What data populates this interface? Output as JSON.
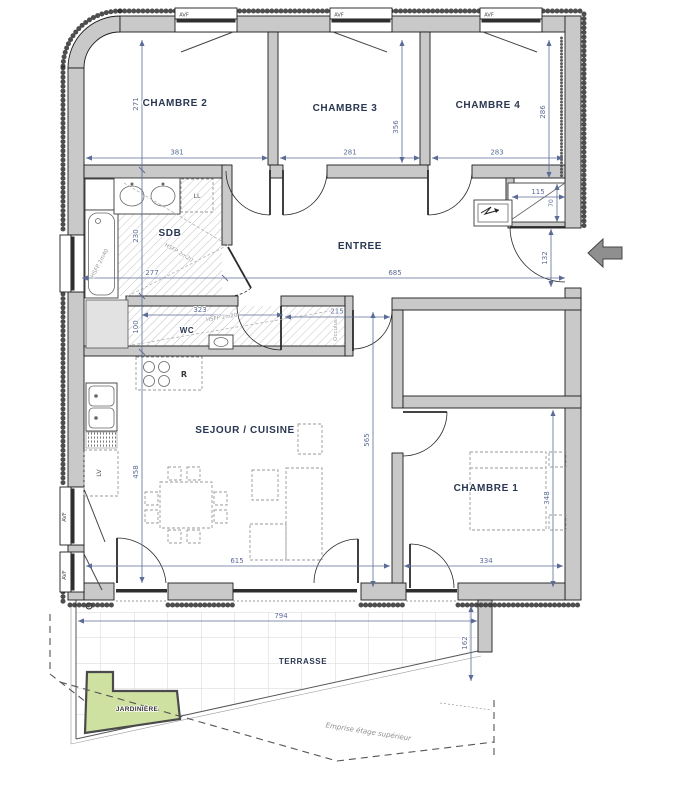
{
  "rooms": {
    "chambre1": "CHAMBRE 1",
    "chambre2": "CHAMBRE 2",
    "chambre3": "CHAMBRE 3",
    "chambre4": "CHAMBRE 4",
    "sdb": "SDB",
    "wc": "WC",
    "entree": "ENTREE",
    "sejour": "SEJOUR / CUISINE",
    "terrasse": "TERRASSE",
    "jardiniere": "JARDINIÈRE"
  },
  "dims": {
    "d271": "271",
    "d381": "381",
    "d356": "356",
    "d281": "281",
    "d283": "283",
    "d286": "286",
    "d115": "115",
    "d70": "70",
    "d132": "132",
    "d685": "685",
    "d277": "277",
    "d230": "230",
    "d323": "323",
    "d215": "215",
    "d100": "100",
    "d565": "565",
    "d458": "458",
    "d615": "615",
    "d334": "334",
    "d348": "348",
    "d794": "794",
    "d162": "162"
  },
  "labels": {
    "avf": "AVF",
    "washing_machine": "LL",
    "fridge": "R",
    "dishwasher": "LV",
    "occulus": "Occulus",
    "hsfp_2m40": "HSFP 2m40",
    "hsfp_2m20": "HSFP 2m20",
    "emprise": "Emprise étage supérieur"
  },
  "colors": {
    "wall_fill": "#c9c9c9",
    "dimension": "#5b6c96",
    "room_label": "#2a3752",
    "jardiniere_fill": "#cfe1a1",
    "annotation": "#8f8f8f"
  }
}
